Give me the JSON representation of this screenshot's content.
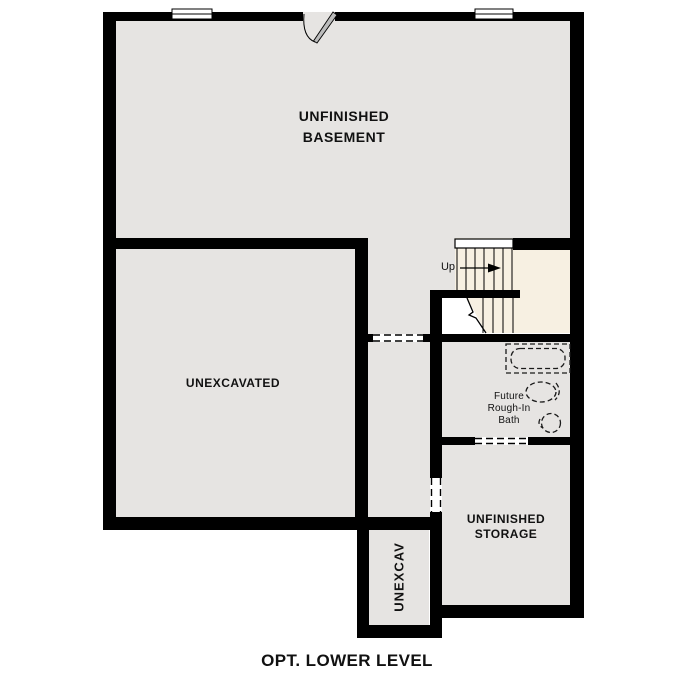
{
  "plan_title": "OPT. LOWER LEVEL",
  "rooms": {
    "basement": {
      "line1": "UNFINISHED",
      "line2": "BASEMENT"
    },
    "unexcavated": {
      "label": "UNEXCAVATED"
    },
    "bath": {
      "line1": "Future",
      "line2": "Rough-In",
      "line3": "Bath"
    },
    "storage": {
      "line1": "UNFINISHED",
      "line2": "STORAGE"
    },
    "unexcav": {
      "label": "UNEXCAV"
    }
  },
  "stairs": {
    "direction_label": "Up"
  },
  "colors": {
    "wall": "#000000",
    "floor": "#e6e4e2",
    "stair_floor": "#f7f0e2",
    "background": "#ffffff",
    "text": "#111111"
  }
}
